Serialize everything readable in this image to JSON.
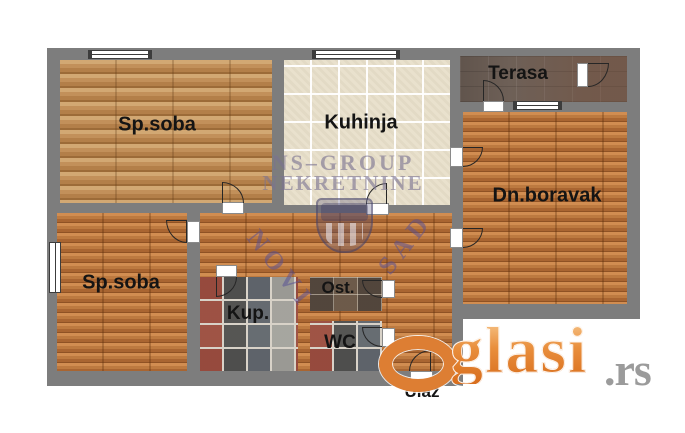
{
  "title": "Apartment floor plan",
  "rooms": {
    "bedroom_top": {
      "label": "Sp.soba"
    },
    "kitchen": {
      "label": "Kuhinja"
    },
    "terrace": {
      "label": "Terasa"
    },
    "living_room": {
      "label": "Dn.boravak"
    },
    "bedroom_bottom": {
      "label": "Sp.soba"
    },
    "storage": {
      "label": "Ost."
    },
    "bathroom": {
      "label": "Kup."
    },
    "toilet": {
      "label": "WC"
    },
    "entrance": {
      "label": "Ulaz"
    }
  },
  "watermarks": {
    "agency": {
      "line1": "NS–GROUP",
      "line2": "NEKRETNINE",
      "badge_text_left": "NOVI",
      "badge_text_right": "SAD"
    },
    "site": {
      "name": "Oglasi.rs",
      "text_after_o": "glasi",
      "tld": ".rs"
    }
  },
  "colors": {
    "wall": "#7d7d7d",
    "wood_light": "#c2905a",
    "wood_orange": "#bd7a40",
    "kitchen_tile": "#e9e1cd",
    "terrace_floor": "#6e6057",
    "stone_tile_accent": "#a84434",
    "watermark_agency": "#7a7292",
    "watermark_site_orange": "#dd7e33",
    "background": "#ffffff"
  }
}
